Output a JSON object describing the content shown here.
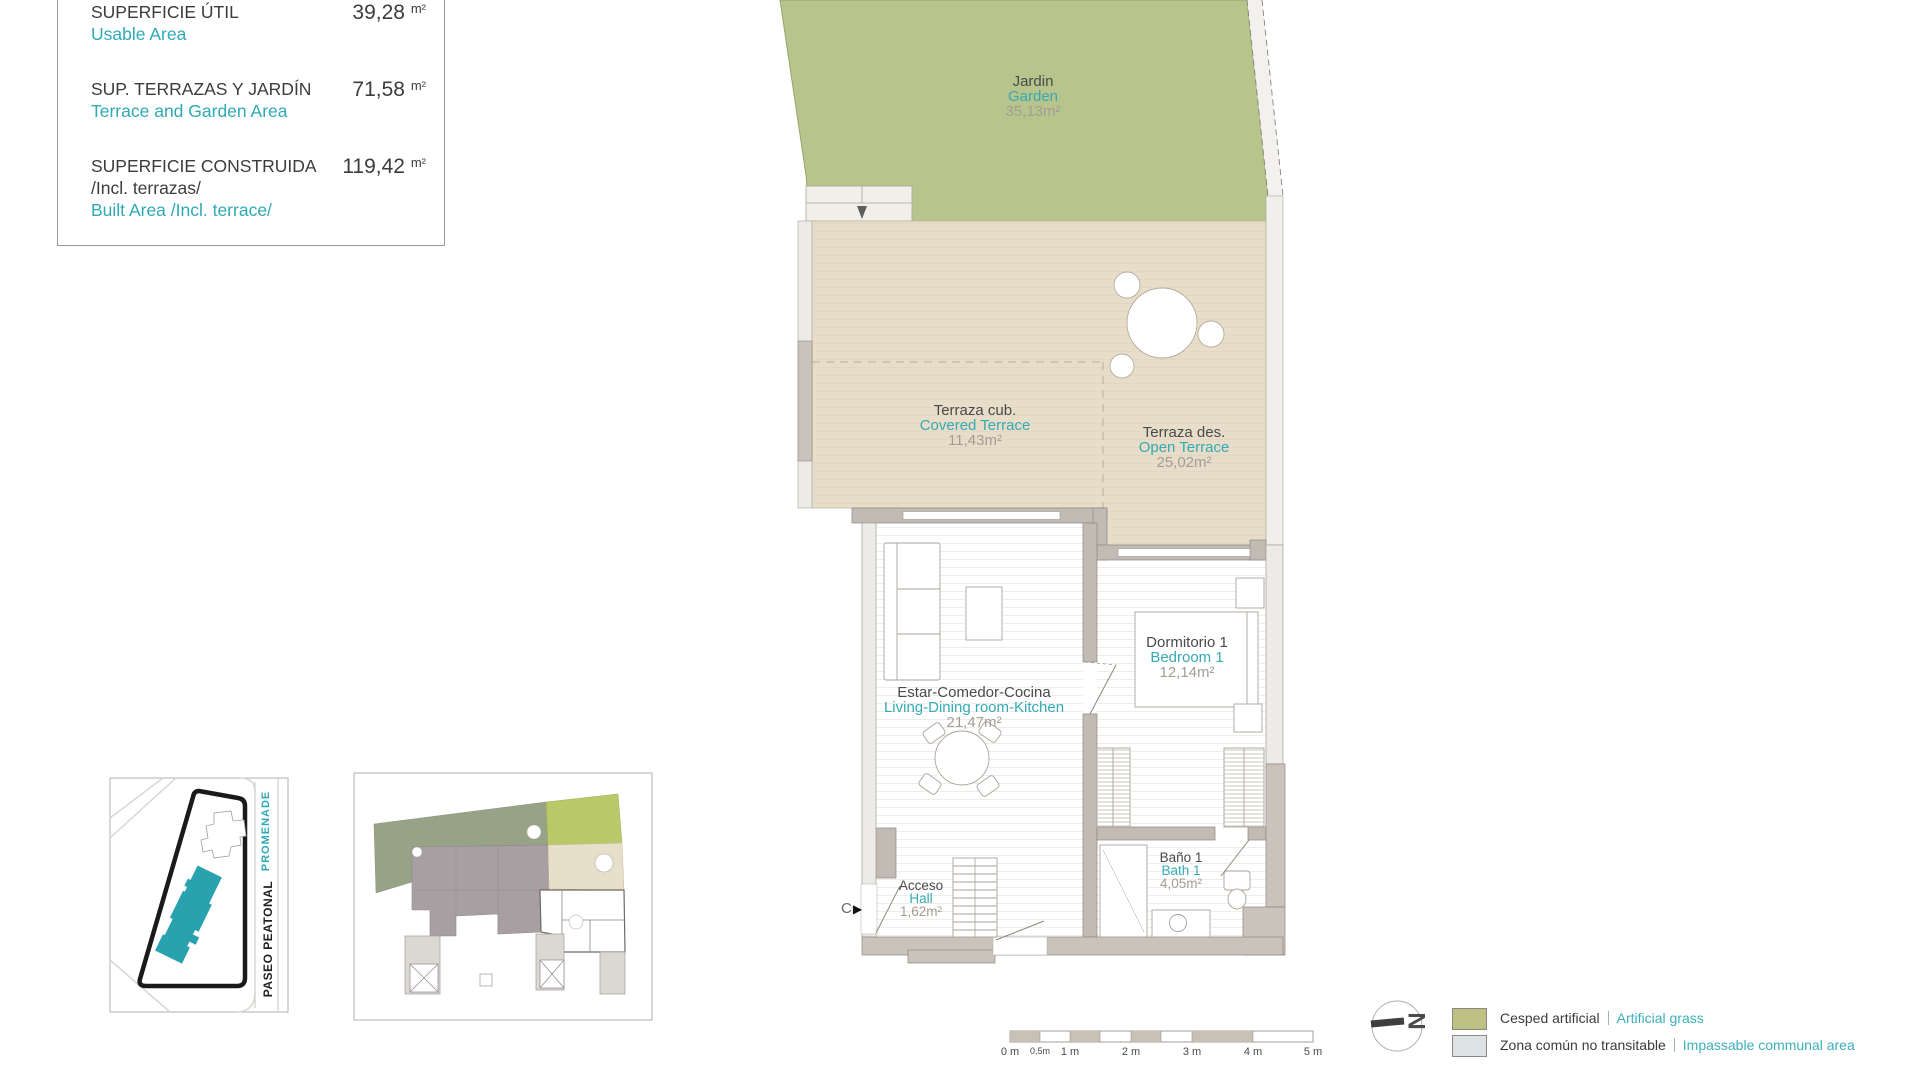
{
  "area_table": {
    "rows": [
      {
        "es": "SUPERFICIE ÚTIL",
        "en": "Usable Area",
        "value": "39,28",
        "unit": "m²"
      },
      {
        "es": "SUP. TERRAZAS Y JARDÍN",
        "en": "Terrace and Garden Area",
        "value": "71,58",
        "unit": "m²"
      },
      {
        "es": "SUPERFICIE CONSTRUIDA",
        "es_sub": "/Incl. terrazas/",
        "en": "Built Area /Incl. terrace/",
        "value": "119,42",
        "unit": "m²"
      }
    ]
  },
  "rooms": [
    {
      "es": "Jardin",
      "en": "Garden",
      "area": "35,13m²"
    },
    {
      "es": "Terraza cub.",
      "en": "Covered Terrace",
      "area": "11,43m²"
    },
    {
      "es": "Terraza des.",
      "en": "Open Terrace",
      "area": "25,02m²"
    },
    {
      "es": "Estar-Comedor-Cocina",
      "en": "Living-Dining room-Kitchen",
      "area": "21,47m²"
    },
    {
      "es": "Dormitorio 1",
      "en": "Bedroom 1",
      "area": "12,14m²"
    },
    {
      "es": "Baño 1",
      "en": "Bath 1",
      "area": "4,05m²"
    },
    {
      "es": "Acceso",
      "en": "Hall",
      "area": "1,62m²"
    }
  ],
  "entrance_marker": {
    "letter": "C",
    "arrow": "▶"
  },
  "site_map": {
    "street_promenade": "PROMENADE",
    "street_paseo": "PASEO PEATONAL"
  },
  "scale_bar": {
    "labels": [
      "0 m",
      "0,5m",
      "1 m",
      "2 m",
      "3 m",
      "4 m",
      "5 m"
    ]
  },
  "compass": {
    "letter": "N"
  },
  "legend": {
    "items": [
      {
        "es": "Cesped artificial",
        "en": "Artificial grass",
        "color": "#bdc183"
      },
      {
        "es": "Zona común no transitable",
        "en": "Impassable communal area",
        "color": "#dde3e5"
      }
    ]
  },
  "colors": {
    "garden_green": "#b7c48b",
    "terrace_beige": "#e7ddc8",
    "accent_teal": "#2fa9b4",
    "wall_gray": "#c2bbb4",
    "footprint_teal": "#27a2ae",
    "plot_outline": "#1a1a1a"
  }
}
